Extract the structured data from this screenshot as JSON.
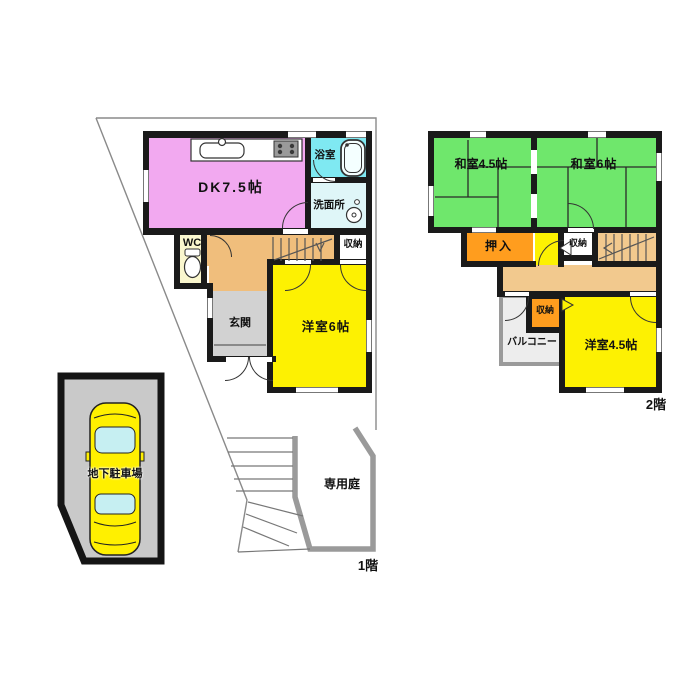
{
  "floor1": {
    "floor_label": "1階",
    "dk": "DK7.5帖",
    "bath": "浴室",
    "washroom": "洗面所",
    "wc": "WC",
    "entrance": "玄関",
    "western6": "洋室6帖",
    "storage": "収納",
    "garden": "専用庭",
    "garage": "地下駐車場"
  },
  "floor2": {
    "floor_label": "2階",
    "japanese45": "和室4.5帖",
    "japanese6": "和室6帖",
    "oshiire": "押入",
    "storage_upper": "収納",
    "storage_lower": "収納",
    "balcony": "バルコニー",
    "western45": "洋室4.5帖"
  },
  "colors": {
    "wall": "#1a1a1a",
    "dk_pink": "#F2A9F0",
    "bath_cyan": "#7FE9F2",
    "washroom_cyan": "#DFF6F8",
    "wc_yellow": "#FAF7CE",
    "hall_tan": "#F0BE7C",
    "entrance_gray": "#D2D2D2",
    "room_yellow": "#FDF102",
    "tatami_green": "#6FE76C",
    "closet_orange": "#FF9D1E",
    "corridor_tan": "#F2C98E",
    "balcony_gray": "#EDEDED",
    "garage_gray": "#C9C9C9",
    "car_yellow": "#FFF000",
    "car_glass_cyan": "#C6EFF2",
    "fence_gray": "#9A9A9A"
  }
}
